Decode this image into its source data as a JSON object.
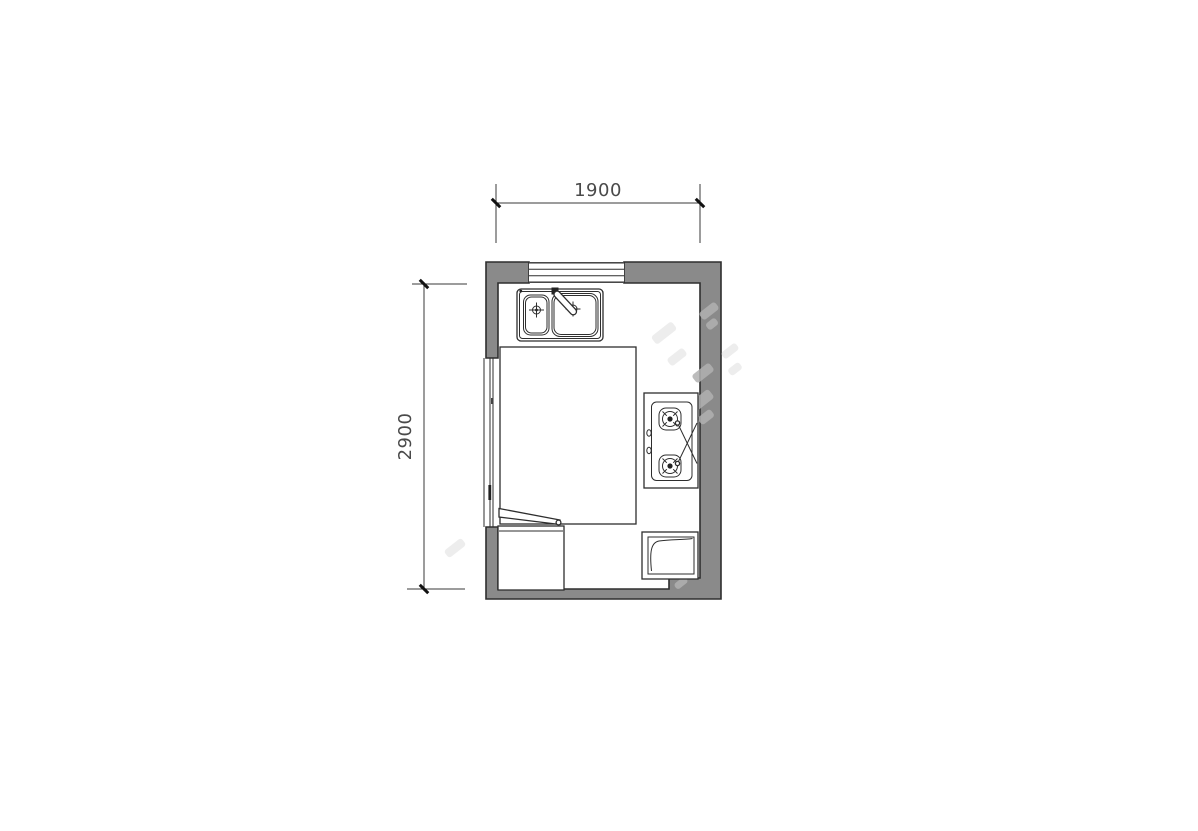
{
  "plan": {
    "dimensions": {
      "width_label": "1900",
      "height_label": "2900"
    },
    "colors": {
      "wall_fill": "#8a8a8a",
      "drawing_line": "#2e2e2e",
      "dimension_line": "#3a3a3a",
      "dimension_text": "#4a4a4a",
      "watermark": "#b0b0b0",
      "background": "#ffffff"
    },
    "fixtures": {
      "window": "window",
      "sliding_door": "sliding-door",
      "sink": "double-basin-sink",
      "faucet": "faucet",
      "counter": "counter-outline",
      "cooktop": "two-burner-gas-cooktop",
      "removal_mark": "x-mark",
      "cabinet": "base-cabinet",
      "door_leaf": "door-leaf",
      "appliance": "appliance-box"
    }
  }
}
